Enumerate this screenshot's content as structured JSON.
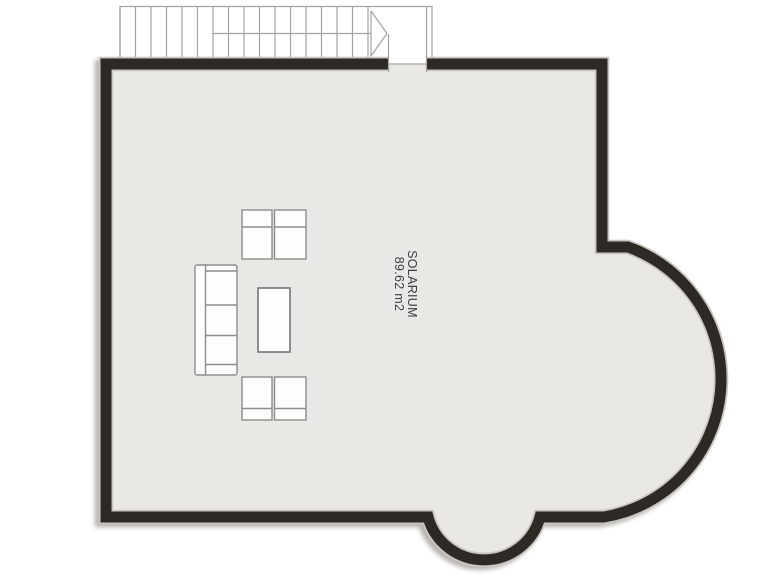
{
  "room": {
    "name": "SOLARIUM",
    "area": "89.62 m2"
  },
  "colors": {
    "background": "#ffffff",
    "wall": "#2d2a26",
    "floor": "#e9e8e5",
    "rim": "#c9c6c1",
    "stair_line": "#a3a3a3",
    "threshold_line": "#b5b2ae",
    "furniture_fill": "#fdfdfc",
    "furniture_stroke": "#8d8d8d",
    "table_stroke": "#7d7d7d",
    "label_text": "#3d3d3d"
  },
  "stairs": {
    "tread_count": 17,
    "tread_start_x": 120,
    "tread_spacing": 15.5,
    "direction": "arrow-right"
  },
  "furniture": {
    "sofa_count": 1,
    "sofa_seat_cushions": 3,
    "armchair_count": 4,
    "coffee_table_count": 1
  }
}
